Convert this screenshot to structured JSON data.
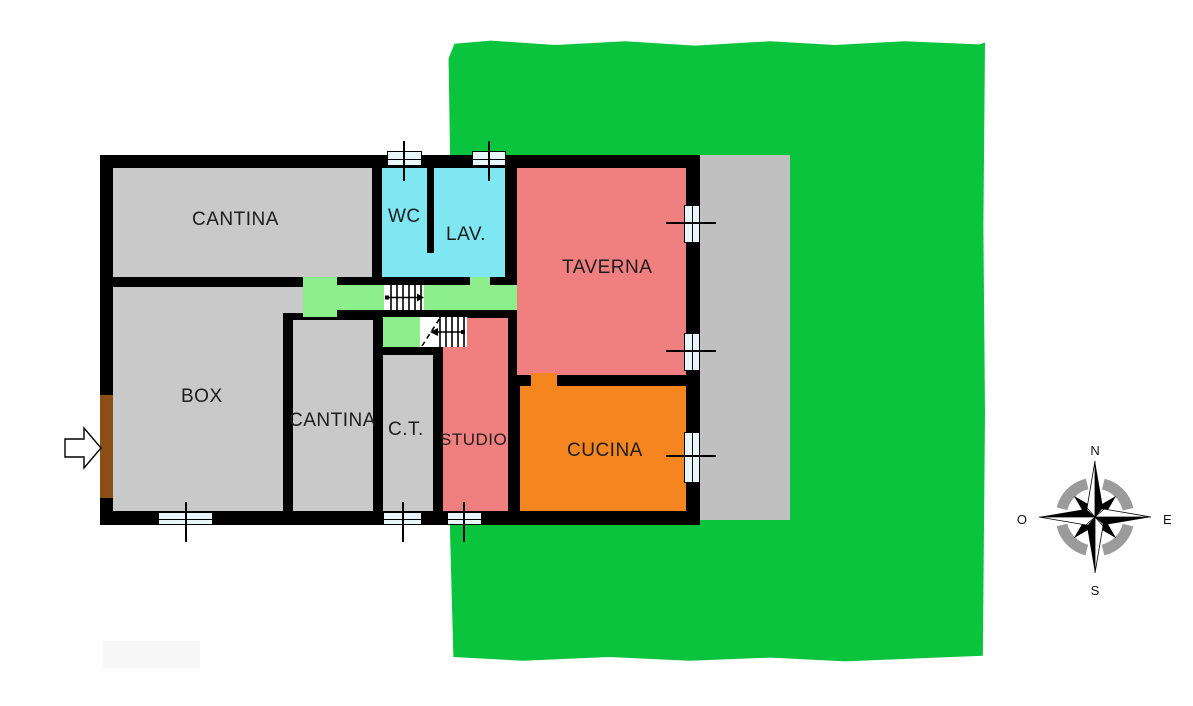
{
  "floorplan": {
    "rooms": {
      "cantina_upper": {
        "label": "CANTINA"
      },
      "wc": {
        "label": "WC"
      },
      "lav": {
        "label": "LAV."
      },
      "taverna": {
        "label": "TAVERNA"
      },
      "box": {
        "label": "BOX"
      },
      "cantina_lower": {
        "label": "CANTINA"
      },
      "ct": {
        "label": "C.T."
      },
      "studio": {
        "label": "STUDIO"
      },
      "cucina": {
        "label": "CUCINA"
      }
    }
  },
  "compass": {
    "north": "N",
    "south": "S",
    "east": "E",
    "west": "O"
  },
  "colors": {
    "lawn": "#0bc43e",
    "hall": "#8cef8b",
    "room": "#c9c9c9",
    "patio": "#c0c0c0",
    "wet": "#7fe7f2",
    "salmon": "#f08080",
    "orange": "#f5861f",
    "window": "#e8f6fa",
    "wall": "#000000",
    "door": "#8a4f17"
  }
}
